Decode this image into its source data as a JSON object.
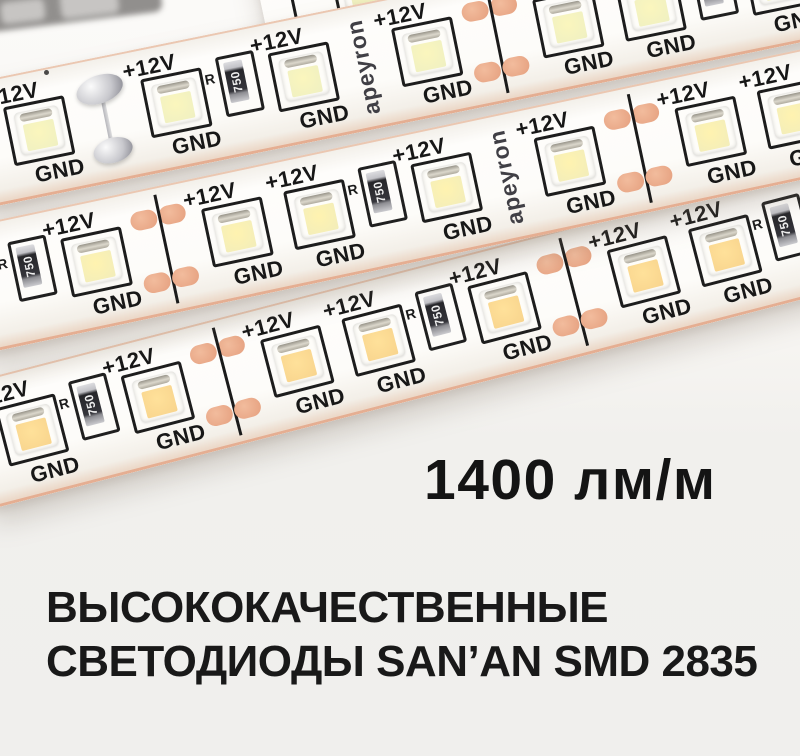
{
  "scene": {
    "background_top": "#fbfaf8",
    "background_bottom": "#f0efed",
    "strip_surface": "#fdfcf9",
    "copper_color": "#e9a98c",
    "silkscreen_color": "#1d1d1d"
  },
  "strip": {
    "brand": "apeyron",
    "plus_label": "+12V",
    "gnd_label": "GND",
    "resistor_prefix": "R",
    "resistor_value": "750"
  },
  "strips": [
    {
      "left": 250,
      "top": -48,
      "width": 560,
      "height": 118,
      "angle": -12,
      "pad": 0,
      "z": 2,
      "led_center": "#f9f6c0",
      "led_edge": "#edeec0",
      "cells": [
        "cut",
        "led",
        "res",
        "led",
        "led",
        "cut",
        "led"
      ]
    },
    {
      "left": -40,
      "top": 85,
      "width": 1015,
      "height": 126,
      "angle": -11.5,
      "pad": 24,
      "z": 3,
      "led_center": "#fbf6bd",
      "led_edge": "#eff0c2",
      "cells": [
        "led",
        "solder",
        "led",
        "res",
        "led",
        "brand",
        "led",
        "cut",
        "led",
        "led",
        "res",
        "led",
        "cut"
      ]
    },
    {
      "left": -40,
      "top": 228,
      "width": 1075,
      "height": 128,
      "angle": -12,
      "pad": 36,
      "z": 3,
      "led_center": "#fff3b0",
      "led_edge": "#f2edba",
      "cells": [
        "res",
        "led",
        "cut",
        "led",
        "led",
        "res",
        "led",
        "brand",
        "led",
        "cut",
        "led",
        "led",
        "res",
        "led"
      ]
    },
    {
      "left": -40,
      "top": 385,
      "width": 1005,
      "height": 128,
      "angle": -14.5,
      "pad": 14,
      "z": 2,
      "led_center": "#ffe19a",
      "led_edge": "#f8d48d",
      "cells": [
        "led",
        "res",
        "led",
        "cut",
        "led",
        "led",
        "res",
        "led",
        "cut",
        "led",
        "led",
        "res"
      ]
    }
  ],
  "headline": {
    "text": "1400 лм/м"
  },
  "subheading": {
    "line1": "ВЫСОКОКАЧЕСТВЕННЫЕ",
    "line2": "СВЕТОДИОДЫ SAN’AN SMD 2835"
  }
}
